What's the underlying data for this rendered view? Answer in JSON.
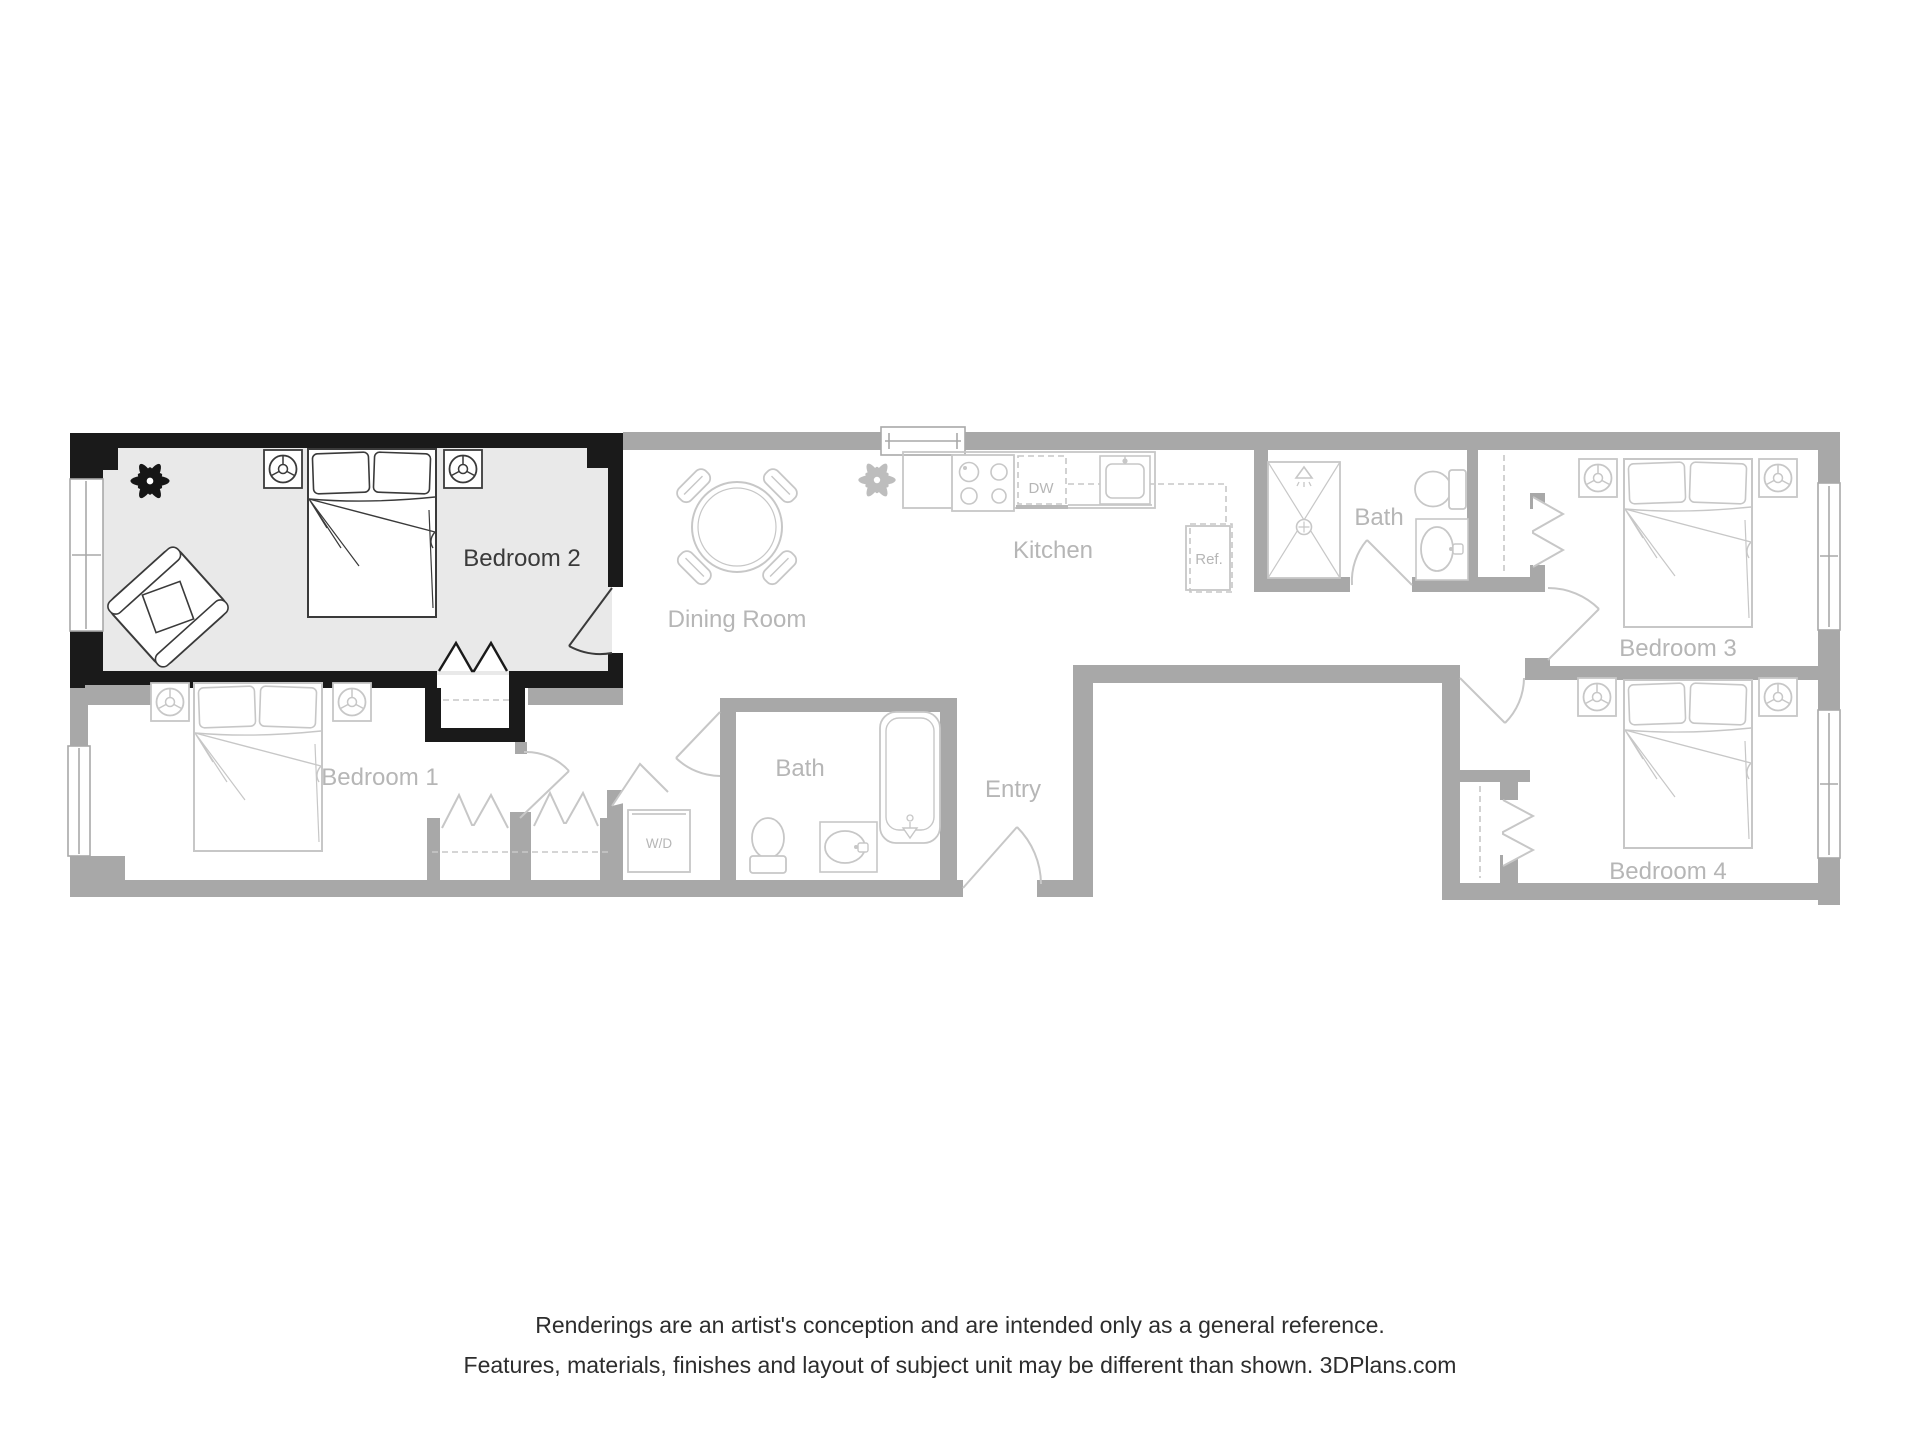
{
  "plan": {
    "highlighted_room": "Bedroom 2",
    "rooms": {
      "bedroom1": "Bedroom 1",
      "bedroom2": "Bedroom 2",
      "bedroom3": "Bedroom 3",
      "bedroom4": "Bedroom 4",
      "dining": "Dining Room",
      "kitchen": "Kitchen",
      "bath_upper": "Bath",
      "bath_main": "Bath",
      "entry": "Entry"
    },
    "appliances": {
      "dishwasher": "DW",
      "refrigerator": "Ref.",
      "washer_dryer": "W/D"
    },
    "colors": {
      "highlight_wall": "#1a1a1a",
      "highlight_floor": "#e9e9e9",
      "wall_gray": "#a8a8a8",
      "line_gray": "#c7c7c7",
      "furniture_dark": "#3a3a3a",
      "label_gray": "#b6b6b6",
      "label_dark": "#3a3a3a",
      "footer_text": "#2d2d2d"
    }
  },
  "footer": {
    "line1": "Renderings are an artist's conception and are intended only as a general reference.",
    "line2": "Features, materials, finishes and layout of subject unit may be different than shown. 3DPlans.com"
  }
}
